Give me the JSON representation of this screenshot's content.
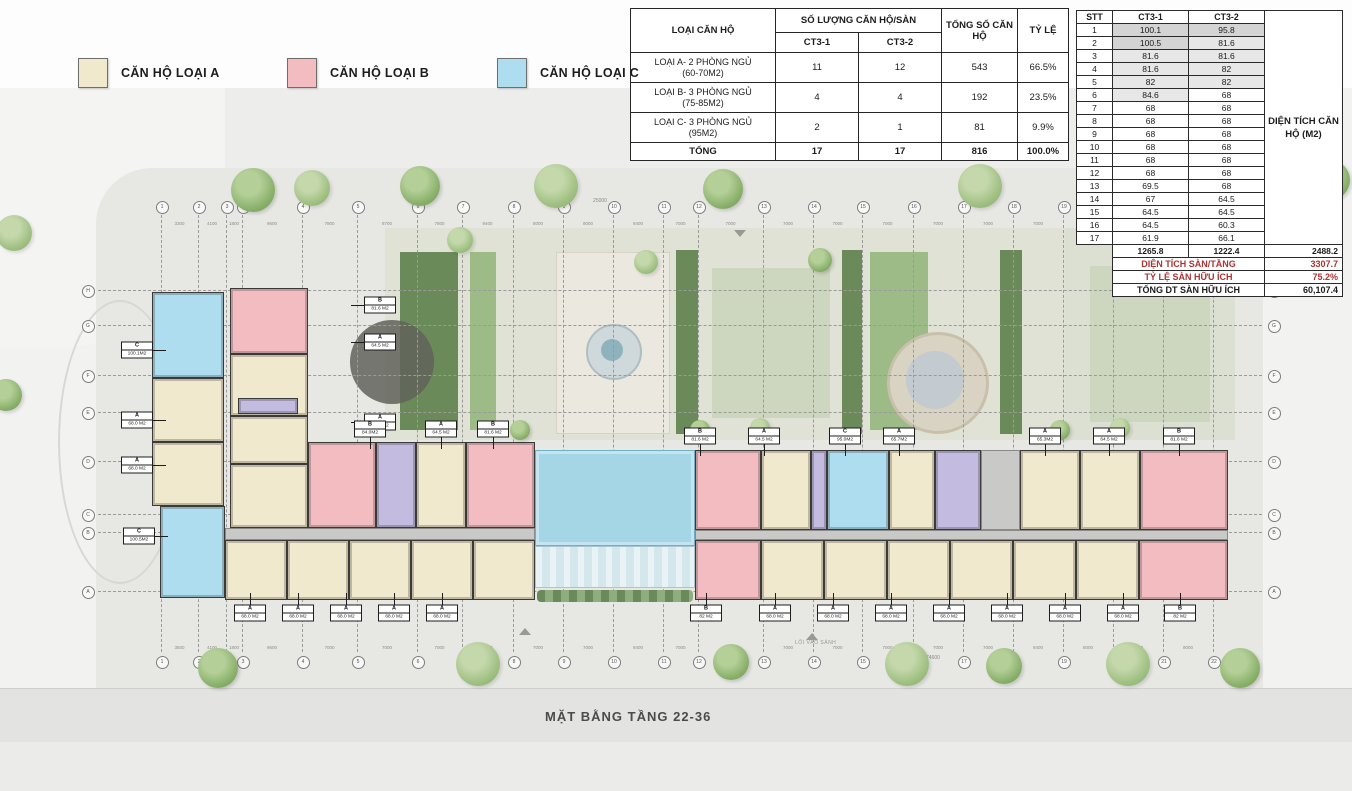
{
  "page": {
    "caption": "MẶT BẰNG TẦNG 22-36",
    "entrance_text": "LỐI VÀO SẢNH"
  },
  "legend": {
    "items": [
      {
        "label": "CĂN HỘ LOẠI A",
        "color": "#f0e9cd",
        "x": 78
      },
      {
        "label": "CĂN HỘ LOẠI B",
        "color": "#f3bcc0",
        "x": 287
      },
      {
        "label": "CĂN HỘ LOẠI C",
        "color": "#aeddef",
        "x": 497
      }
    ]
  },
  "summary_table": {
    "header": {
      "type": "LOẠI CĂN HỘ",
      "group": "SỐ LƯỢNG CĂN HỘ/SÀN",
      "sub1": "CT3-1",
      "sub2": "CT3-2",
      "total": "TỔNG SỐ CĂN HỘ",
      "ratio": "TỶ LỆ"
    },
    "rows": [
      {
        "name": "LOẠI A- 2 PHÒNG NGỦ",
        "sub": "(60-70M2)",
        "ct31": "11",
        "ct32": "12",
        "total": "543",
        "ratio": "66.5%"
      },
      {
        "name": "LOẠI B- 3 PHÒNG NGỦ",
        "sub": "(75-85M2)",
        "ct31": "4",
        "ct32": "4",
        "total": "192",
        "ratio": "23.5%"
      },
      {
        "name": "LOẠI C- 3 PHÒNG NGỦ",
        "sub": "(95M2)",
        "ct31": "2",
        "ct32": "1",
        "total": "81",
        "ratio": "9.9%"
      }
    ],
    "total_row": {
      "name": "TỔNG",
      "ct31": "17",
      "ct32": "17",
      "total": "816",
      "ratio": "100.0%"
    }
  },
  "area_table": {
    "headers": [
      "STT",
      "CT3-1",
      "CT3-2"
    ],
    "side_label": "DIỆN TÍCH CĂN HỘ (M2)",
    "rows": [
      [
        "1",
        "100.1",
        "95.8"
      ],
      [
        "2",
        "100.5",
        "81.6"
      ],
      [
        "3",
        "81.6",
        "81.6"
      ],
      [
        "4",
        "81.6",
        "82"
      ],
      [
        "5",
        "82",
        "82"
      ],
      [
        "6",
        "84.6",
        "68"
      ],
      [
        "7",
        "68",
        "68"
      ],
      [
        "8",
        "68",
        "68"
      ],
      [
        "9",
        "68",
        "68"
      ],
      [
        "10",
        "68",
        "68"
      ],
      [
        "11",
        "68",
        "68"
      ],
      [
        "12",
        "68",
        "68"
      ],
      [
        "13",
        "69.5",
        "68"
      ],
      [
        "14",
        "67",
        "64.5"
      ],
      [
        "15",
        "64.5",
        "64.5"
      ],
      [
        "16",
        "64.5",
        "60.3"
      ],
      [
        "17",
        "61.9",
        "66.1"
      ]
    ],
    "sum_row": {
      "ct31": "1265.8",
      "ct32": "1222.4",
      "total": "2488.2"
    },
    "footer_rows": [
      {
        "label": "DIỆN TÍCH SÀN/TẦNG",
        "value": "3307.7",
        "red": true
      },
      {
        "label": "TỶ LỆ SÀN HỮU ÍCH",
        "value": "75.2%",
        "red": true
      },
      {
        "label": "TỔNG DT SÀN HỮU ÍCH",
        "value": "60,107.4",
        "red": false
      }
    ]
  },
  "plan": {
    "grid": {
      "cols": [
        161,
        198,
        226,
        242,
        302,
        357,
        417,
        462,
        513,
        563,
        613,
        663,
        698,
        763,
        813,
        862,
        913,
        963,
        1013,
        1063,
        1113,
        1163,
        1213
      ],
      "col_labels": [
        "1",
        "2",
        "3",
        "3",
        "4",
        "5",
        "6",
        "7",
        "8",
        "9",
        "10",
        "11",
        "12",
        "13",
        "14",
        "15",
        "16",
        "17",
        "18",
        "19",
        "20",
        "21",
        "22"
      ],
      "col_circle_top_y": 206,
      "col_circle_bot_y": 661,
      "col_line_y1": 215,
      "col_line_y2": 652,
      "rows": [
        290,
        325,
        375,
        412,
        461,
        514,
        532,
        591
      ],
      "row_labels": [
        "H",
        "G",
        "F",
        "E",
        "D",
        "C",
        "B",
        "A"
      ],
      "row_circle_left_x": 87,
      "row_circle_right_x": 1273,
      "row_line_x1": 98,
      "row_line_x2": 1262,
      "top_dims": [
        "3300",
        "4100",
        "1800",
        "9600",
        "7800",
        "8700",
        "7800",
        "9400",
        "8000",
        "8000",
        "9400",
        "7000",
        "7000",
        "7000",
        "7000",
        "7000",
        "7000",
        "7000",
        "7000",
        "9400",
        "8000",
        "9400"
      ],
      "bot_dims": [
        "3500",
        "4100",
        "1800",
        "9600",
        "7000",
        "7000",
        "7000",
        "7000",
        "7000",
        "7000",
        "9400",
        "7000",
        "7000",
        "7000",
        "7000",
        "7000",
        "7000",
        "7000",
        "9400",
        "8000",
        "9400",
        "8000"
      ],
      "top_dims_y": 221,
      "bot_dims_y": 645,
      "top_total_dim": "25000",
      "top_total_x": 600,
      "top_total_y": 198,
      "bot_total_dim": "74600",
      "bot_total_x": 933,
      "bot_total_y": 655
    },
    "garden_rects": [
      {
        "x": 385,
        "y": 228,
        "w": 680,
        "h": 212,
        "c": "garden"
      },
      {
        "x": 1065,
        "y": 228,
        "w": 170,
        "h": 212,
        "c": "garden2"
      },
      {
        "x": 400,
        "y": 252,
        "w": 58,
        "h": 178,
        "c": "hedge"
      },
      {
        "x": 470,
        "y": 252,
        "w": 26,
        "h": 178,
        "c": "shrub"
      },
      {
        "x": 556,
        "y": 252,
        "w": 112,
        "h": 180,
        "c": "paving"
      },
      {
        "x": 676,
        "y": 250,
        "w": 22,
        "h": 184,
        "c": "hedge"
      },
      {
        "x": 712,
        "y": 268,
        "w": 118,
        "h": 150,
        "c": "lawn"
      },
      {
        "x": 842,
        "y": 250,
        "w": 20,
        "h": 184,
        "c": "hedge"
      },
      {
        "x": 870,
        "y": 252,
        "w": 58,
        "h": 178,
        "c": "shrub"
      },
      {
        "x": 1000,
        "y": 250,
        "w": 22,
        "h": 184,
        "c": "hedge"
      },
      {
        "x": 1090,
        "y": 266,
        "w": 120,
        "h": 156,
        "c": "lawn"
      }
    ],
    "garden_circles": [
      {
        "cx": 392,
        "cy": 362,
        "r": 42,
        "c": "canopy"
      },
      {
        "cx": 612,
        "cy": 350,
        "r": 26,
        "c": "fring"
      },
      {
        "cx": 612,
        "cy": 350,
        "r": 11,
        "c": "fcore"
      },
      {
        "cx": 935,
        "cy": 380,
        "r": 48,
        "c": "plaza"
      },
      {
        "cx": 935,
        "cy": 380,
        "r": 29,
        "c": "plazain"
      }
    ],
    "blocks": [
      {
        "x": 152,
        "y": 292,
        "w": 72,
        "h": 86,
        "t": "C"
      },
      {
        "x": 152,
        "y": 378,
        "w": 72,
        "h": 64,
        "t": "A"
      },
      {
        "x": 152,
        "y": 442,
        "w": 72,
        "h": 64,
        "t": "A"
      },
      {
        "x": 160,
        "y": 506,
        "w": 65,
        "h": 92,
        "t": "C"
      },
      {
        "x": 230,
        "y": 288,
        "w": 78,
        "h": 66,
        "t": "B"
      },
      {
        "x": 230,
        "y": 354,
        "w": 78,
        "h": 62,
        "t": "A"
      },
      {
        "x": 230,
        "y": 416,
        "w": 78,
        "h": 48,
        "t": "A"
      },
      {
        "x": 230,
        "y": 464,
        "w": 78,
        "h": 64,
        "t": "A"
      },
      {
        "x": 238,
        "y": 398,
        "w": 60,
        "h": 16,
        "t": "core"
      },
      {
        "x": 308,
        "y": 442,
        "w": 68,
        "h": 86,
        "t": "B"
      },
      {
        "x": 376,
        "y": 442,
        "w": 40,
        "h": 86,
        "t": "core"
      },
      {
        "x": 416,
        "y": 442,
        "w": 50,
        "h": 86,
        "t": "A"
      },
      {
        "x": 466,
        "y": 442,
        "w": 69,
        "h": 86,
        "t": "B"
      },
      {
        "x": 225,
        "y": 528,
        "w": 310,
        "h": 12,
        "t": "corr"
      },
      {
        "x": 225,
        "y": 540,
        "w": 62,
        "h": 60,
        "t": "A"
      },
      {
        "x": 287,
        "y": 540,
        "w": 62,
        "h": 60,
        "t": "A"
      },
      {
        "x": 349,
        "y": 540,
        "w": 62,
        "h": 60,
        "t": "A"
      },
      {
        "x": 411,
        "y": 540,
        "w": 62,
        "h": 60,
        "t": "A"
      },
      {
        "x": 473,
        "y": 540,
        "w": 62,
        "h": 60,
        "t": "A"
      },
      {
        "x": 535,
        "y": 450,
        "w": 160,
        "h": 96,
        "t": "pool"
      },
      {
        "x": 535,
        "y": 546,
        "w": 160,
        "h": 42,
        "t": "deck"
      },
      {
        "x": 537,
        "y": 590,
        "w": 156,
        "h": 12,
        "t": "shrubrow"
      },
      {
        "x": 695,
        "y": 450,
        "w": 66,
        "h": 80,
        "t": "B"
      },
      {
        "x": 761,
        "y": 450,
        "w": 50,
        "h": 80,
        "t": "A"
      },
      {
        "x": 811,
        "y": 450,
        "w": 16,
        "h": 80,
        "t": "core"
      },
      {
        "x": 827,
        "y": 450,
        "w": 62,
        "h": 80,
        "t": "C"
      },
      {
        "x": 889,
        "y": 450,
        "w": 46,
        "h": 80,
        "t": "A"
      },
      {
        "x": 935,
        "y": 450,
        "w": 46,
        "h": 80,
        "t": "core"
      },
      {
        "x": 981,
        "y": 450,
        "w": 39,
        "h": 80,
        "t": "corr"
      },
      {
        "x": 1020,
        "y": 450,
        "w": 60,
        "h": 80,
        "t": "A"
      },
      {
        "x": 1080,
        "y": 450,
        "w": 60,
        "h": 80,
        "t": "A"
      },
      {
        "x": 1140,
        "y": 450,
        "w": 88,
        "h": 80,
        "t": "B"
      },
      {
        "x": 695,
        "y": 530,
        "w": 533,
        "h": 10,
        "t": "corr"
      },
      {
        "x": 695,
        "y": 540,
        "w": 66,
        "h": 60,
        "t": "B"
      },
      {
        "x": 761,
        "y": 540,
        "w": 63,
        "h": 60,
        "t": "A"
      },
      {
        "x": 824,
        "y": 540,
        "w": 63,
        "h": 60,
        "t": "A"
      },
      {
        "x": 887,
        "y": 540,
        "w": 63,
        "h": 60,
        "t": "A"
      },
      {
        "x": 950,
        "y": 540,
        "w": 63,
        "h": 60,
        "t": "A"
      },
      {
        "x": 1013,
        "y": 540,
        "w": 63,
        "h": 60,
        "t": "A"
      },
      {
        "x": 1076,
        "y": 540,
        "w": 63,
        "h": 60,
        "t": "A"
      },
      {
        "x": 1139,
        "y": 540,
        "w": 89,
        "h": 60,
        "t": "B"
      }
    ],
    "unit_labels": [
      {
        "x": 137,
        "y": 350,
        "l": "C",
        "a": "100.1M2",
        "dir": "r"
      },
      {
        "x": 137,
        "y": 420,
        "l": "A",
        "a": "68.0 M2",
        "dir": "r"
      },
      {
        "x": 137,
        "y": 465,
        "l": "A",
        "a": "68.0 M2",
        "dir": "r"
      },
      {
        "x": 139,
        "y": 536,
        "l": "C",
        "a": "100.5M2",
        "dir": "r"
      },
      {
        "x": 380,
        "y": 305,
        "l": "B",
        "a": "81.6 M2",
        "dir": "l"
      },
      {
        "x": 380,
        "y": 342,
        "l": "A",
        "a": "64.5 M2",
        "dir": "l"
      },
      {
        "x": 380,
        "y": 422,
        "l": "A",
        "a": "67.0 M2",
        "dir": "l"
      },
      {
        "x": 370,
        "y": 429,
        "l": "B",
        "a": "84.0M2",
        "dir": "d"
      },
      {
        "x": 441,
        "y": 429,
        "l": "A",
        "a": "64.5 M2",
        "dir": "d"
      },
      {
        "x": 493,
        "y": 429,
        "l": "B",
        "a": "81.6 M2",
        "dir": "d"
      },
      {
        "x": 700,
        "y": 436,
        "l": "B",
        "a": "81.6 M2",
        "dir": "d"
      },
      {
        "x": 764,
        "y": 436,
        "l": "A",
        "a": "64.5 M2",
        "dir": "d"
      },
      {
        "x": 845,
        "y": 436,
        "l": "C",
        "a": "95.0M2",
        "dir": "d"
      },
      {
        "x": 899,
        "y": 436,
        "l": "A",
        "a": "65.7M2",
        "dir": "d"
      },
      {
        "x": 1045,
        "y": 436,
        "l": "A",
        "a": "65.3M2",
        "dir": "d"
      },
      {
        "x": 1109,
        "y": 436,
        "l": "A",
        "a": "64.5 M2",
        "dir": "d"
      },
      {
        "x": 1179,
        "y": 436,
        "l": "B",
        "a": "81.6 M2",
        "dir": "d"
      },
      {
        "x": 250,
        "y": 613,
        "l": "A",
        "a": "68.0 M2",
        "dir": "u"
      },
      {
        "x": 298,
        "y": 613,
        "l": "A",
        "a": "68.0 M2",
        "dir": "u"
      },
      {
        "x": 346,
        "y": 613,
        "l": "A",
        "a": "68.0 M2",
        "dir": "u"
      },
      {
        "x": 394,
        "y": 613,
        "l": "A",
        "a": "68.0 M2",
        "dir": "u"
      },
      {
        "x": 442,
        "y": 613,
        "l": "A",
        "a": "68.0 M2",
        "dir": "u"
      },
      {
        "x": 706,
        "y": 613,
        "l": "B",
        "a": "82 M2",
        "dir": "u"
      },
      {
        "x": 775,
        "y": 613,
        "l": "A",
        "a": "68.0 M2",
        "dir": "u"
      },
      {
        "x": 833,
        "y": 613,
        "l": "A",
        "a": "68.0 M2",
        "dir": "u"
      },
      {
        "x": 891,
        "y": 613,
        "l": "A",
        "a": "68.0 M2",
        "dir": "u"
      },
      {
        "x": 949,
        "y": 613,
        "l": "A",
        "a": "68.0 M2",
        "dir": "u"
      },
      {
        "x": 1007,
        "y": 613,
        "l": "A",
        "a": "68.0 M2",
        "dir": "u"
      },
      {
        "x": 1065,
        "y": 613,
        "l": "A",
        "a": "68.0 M2",
        "dir": "u"
      },
      {
        "x": 1123,
        "y": 613,
        "l": "A",
        "a": "68.0 M2",
        "dir": "u"
      },
      {
        "x": 1180,
        "y": 613,
        "l": "B",
        "a": "82 M2",
        "dir": "u"
      }
    ],
    "trees": [
      {
        "x": 253,
        "y": 190,
        "r": 22,
        "s": 1
      },
      {
        "x": 312,
        "y": 188,
        "r": 18,
        "s": 2
      },
      {
        "x": 420,
        "y": 186,
        "r": 20,
        "s": 1
      },
      {
        "x": 556,
        "y": 186,
        "r": 22,
        "s": 2
      },
      {
        "x": 723,
        "y": 189,
        "r": 20,
        "s": 1
      },
      {
        "x": 980,
        "y": 186,
        "r": 22,
        "s": 2
      },
      {
        "x": 1105,
        "y": 184,
        "r": 20,
        "s": 1
      },
      {
        "x": 1240,
        "y": 182,
        "r": 24,
        "s": 2
      },
      {
        "x": 1330,
        "y": 180,
        "r": 20,
        "s": 1
      },
      {
        "x": 460,
        "y": 240,
        "r": 13,
        "s": 2
      },
      {
        "x": 646,
        "y": 262,
        "r": 12,
        "s": 2
      },
      {
        "x": 700,
        "y": 430,
        "r": 10,
        "s": 1
      },
      {
        "x": 760,
        "y": 428,
        "r": 10,
        "s": 2
      },
      {
        "x": 1060,
        "y": 430,
        "r": 10,
        "s": 1
      },
      {
        "x": 1120,
        "y": 428,
        "r": 10,
        "s": 2
      },
      {
        "x": 820,
        "y": 260,
        "r": 12,
        "s": 1
      },
      {
        "x": 1140,
        "y": 260,
        "r": 12,
        "s": 2
      },
      {
        "x": 520,
        "y": 430,
        "r": 10,
        "s": 1
      },
      {
        "x": 218,
        "y": 668,
        "r": 20,
        "s": 1
      },
      {
        "x": 478,
        "y": 664,
        "r": 22,
        "s": 2
      },
      {
        "x": 731,
        "y": 662,
        "r": 18,
        "s": 1
      },
      {
        "x": 907,
        "y": 664,
        "r": 22,
        "s": 2
      },
      {
        "x": 1004,
        "y": 666,
        "r": 18,
        "s": 1
      },
      {
        "x": 1128,
        "y": 664,
        "r": 22,
        "s": 2
      },
      {
        "x": 1240,
        "y": 668,
        "r": 20,
        "s": 1
      },
      {
        "x": 14,
        "y": 233,
        "r": 18,
        "s": 2
      },
      {
        "x": 6,
        "y": 395,
        "r": 16,
        "s": 1
      }
    ],
    "arrows": [
      {
        "x": 525,
        "y": 628,
        "dir": "up"
      },
      {
        "x": 812,
        "y": 633,
        "dir": "up"
      },
      {
        "x": 740,
        "y": 230,
        "dir": "down"
      },
      {
        "x": 1300,
        "y": 230,
        "dir": "down"
      }
    ],
    "entrance_text_pos": {
      "x": 795,
      "y": 640
    }
  },
  "colors": {
    "unit_a": "#f0e9cd",
    "unit_b": "#f3bcc0",
    "unit_c": "#aeddef",
    "core": "#c4bbe1",
    "pool": "#a5d6e6",
    "red_text": "#a93434"
  }
}
